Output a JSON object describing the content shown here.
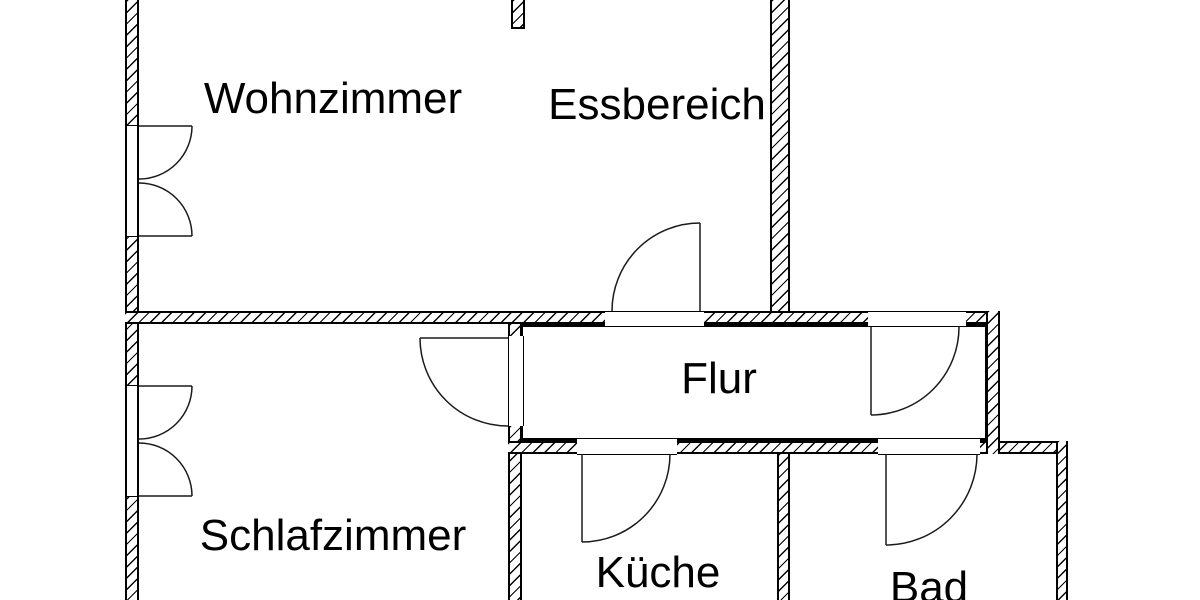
{
  "colors": {
    "background": "#ffffff",
    "wall_line": "#000000",
    "text": "#000000"
  },
  "rooms": [
    {
      "id": "wohnzimmer",
      "label": "Wohnzimmer"
    },
    {
      "id": "essbereich",
      "label": "Essbereich"
    },
    {
      "id": "flur",
      "label": "Flur"
    },
    {
      "id": "schlafzimmer",
      "label": "Schlafzimmer"
    },
    {
      "id": "kueche",
      "label": "Küche"
    },
    {
      "id": "bad",
      "label": "Bad"
    }
  ]
}
